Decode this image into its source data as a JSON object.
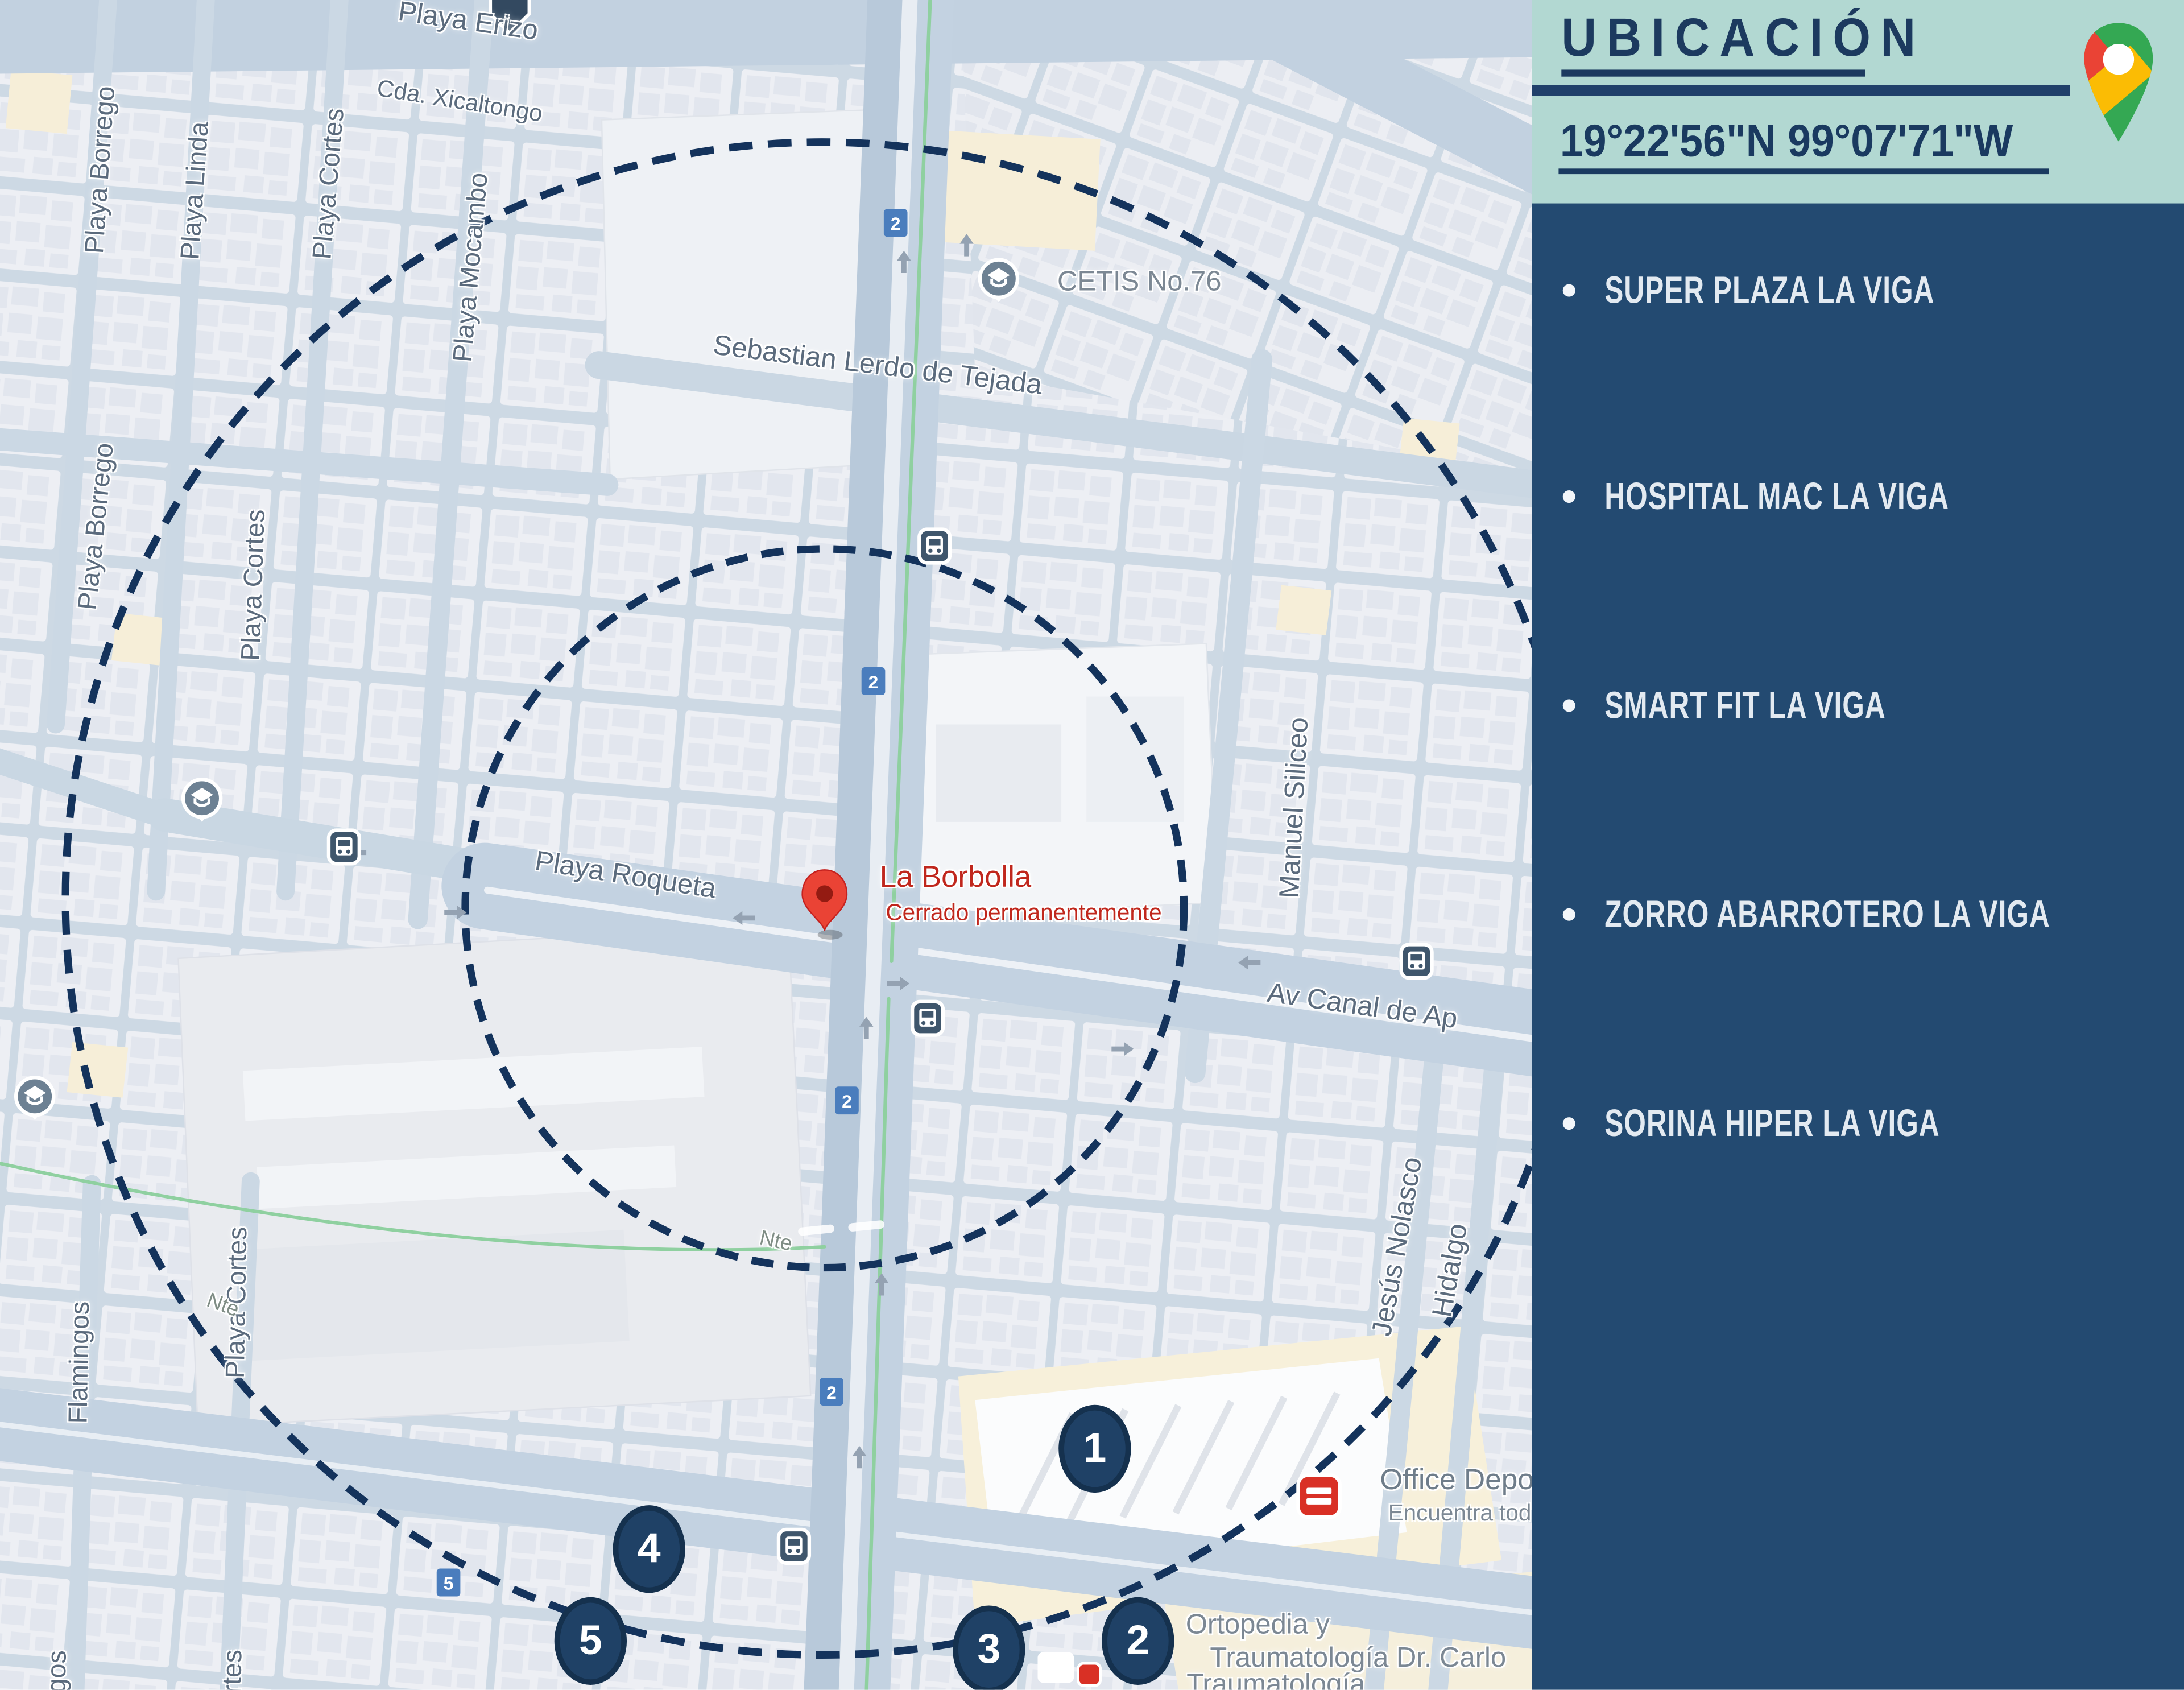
{
  "sidebar": {
    "title": "UBICACIÓN",
    "coordinates": "19°22'56\"N 99°07'71\"W",
    "items": [
      {
        "label": "SUPER PLAZA LA VIGA"
      },
      {
        "label": "HOSPITAL MAC LA VIGA"
      },
      {
        "label": "SMART FIT LA VIGA"
      },
      {
        "label": "ZORRO ABARROTERO LA VIGA"
      },
      {
        "label": "SORINA HIPER LA VIGA"
      }
    ],
    "colors": {
      "header_teal": "#b2d8d2",
      "panel_navy": "#234a71",
      "text_navy": "#1c3a5f",
      "item_text": "#e3eaf1"
    }
  },
  "map": {
    "pin": {
      "name": "La Borbolla",
      "status": "Cerrado permanentemente"
    },
    "streets": [
      {
        "text": "Playa Erizo"
      },
      {
        "text": "Cda. Xicaltongo"
      },
      {
        "text": "Playa Borrego"
      },
      {
        "text": "Playa Borrego"
      },
      {
        "text": "Playa Linda"
      },
      {
        "text": "Playa Cortes"
      },
      {
        "text": "Playa Mocambo"
      },
      {
        "text": "Playa Cortes"
      },
      {
        "text": "Playa Cortes"
      },
      {
        "text": "Flamingos"
      },
      {
        "text": "Sebastian Lerdo de Tejada"
      },
      {
        "text": "Manuel Siliceo"
      },
      {
        "text": "Playa Roqueta"
      },
      {
        "text": "Av Canal de Ap"
      },
      {
        "text": "Jesús Nolasco"
      },
      {
        "text": "Hidalgo"
      },
      {
        "text": "Nte"
      },
      {
        "text": "Nte"
      },
      {
        "text": "gos"
      },
      {
        "text": "rtes"
      }
    ],
    "pois": {
      "cetis": "CETIS No.76",
      "office_depot": "Office Depo",
      "office_depot_sub": "Encuentra tod",
      "ortopedia_1": "Ortopedia y",
      "ortopedia_2": "Traumatología Dr. Carlo",
      "ortopedia_3": "Traumatología"
    },
    "shields": {
      "route2": "2",
      "route5": "5"
    },
    "markers": [
      {
        "n": "1"
      },
      {
        "n": "2"
      },
      {
        "n": "3"
      },
      {
        "n": "4"
      },
      {
        "n": "5"
      }
    ],
    "colors": {
      "radius_circle": "#14335c",
      "marker_navy": "#1f4166",
      "pin_red": "#ea4335",
      "shield_blue": "#4a7dbd",
      "road": "#c3d2e1",
      "block": "#edeff4"
    }
  }
}
